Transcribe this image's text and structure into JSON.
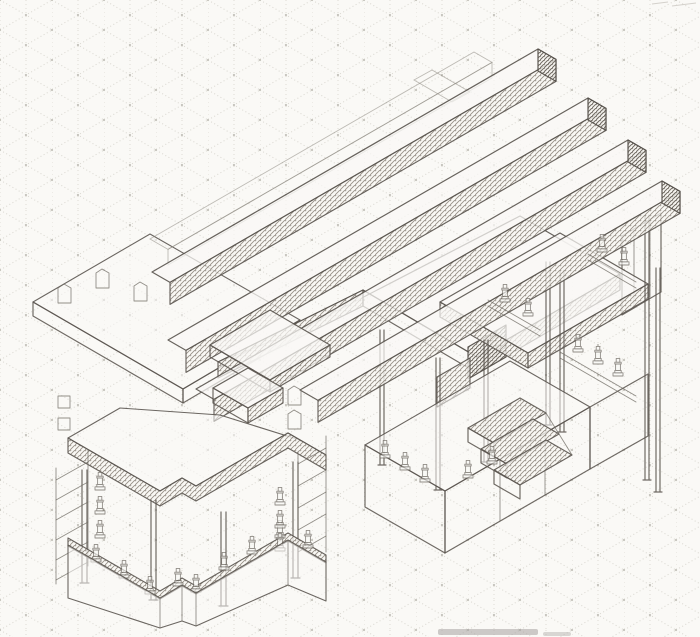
{
  "page": {
    "title": "Hand-drawn isometric architectural sketch",
    "media": "pencil on isometric grid paper",
    "canvas": {
      "width": 700,
      "height": 637
    }
  },
  "palette": {
    "paper": "#faf9f6",
    "grid_dot": "#c9c7c0",
    "grid_line": "#dbd9d2",
    "pencil": "#5c5751",
    "hatch_light": "#90897f",
    "hatch_dark": "#6b655d",
    "smudge": "#a5a3a0"
  },
  "scene": {
    "description": "Axonometric pencil study of a terraced building: long stacked roof beams descending to the right, a central flat roof slab with hatched fascias, a stepped terrace with crenellated parapet teeth on the left, and two open pavilions with slender double-line columns, a three-tread stair, side ladders and rows of small statuettes along the balustrades, all drawn over dotted isometric grid paper.",
    "components": [
      {
        "name": "isometric-grid-paper"
      },
      {
        "name": "roof-beams",
        "count": 5,
        "note": "one faint outline beam plus four hatched beams stepping down to the right"
      },
      {
        "name": "central-roof-slab",
        "fascia": "hatched"
      },
      {
        "name": "left-terrace",
        "features": [
          "crenellated parapet teeth",
          "raised plateau",
          "small box volume"
        ]
      },
      {
        "name": "left-pavilion",
        "columns": 4,
        "statuettes": 15,
        "features": [
          "zigzag roof fascia",
          "balustrade with statuettes",
          "two side ladders",
          "stepped podium base"
        ]
      },
      {
        "name": "right-pavilion",
        "columns": 7,
        "statuettes": 12,
        "features": [
          "upper terrace slab",
          "stair of three treads",
          "podium base",
          "railings with statuettes"
        ]
      },
      {
        "name": "scan-smudge"
      }
    ],
    "counts": {
      "beams": 5,
      "columns": 11,
      "statuettes": 24,
      "stair_treads": 3,
      "ladders": 2
    }
  }
}
